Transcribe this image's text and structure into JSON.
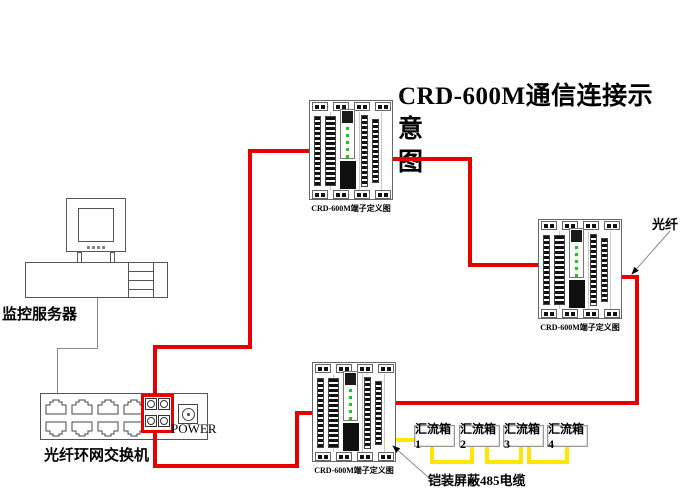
{
  "title": {
    "line1": "CRD-600M通信连接示意",
    "line2": "图"
  },
  "labels": {
    "server": "监控服务器",
    "switch_name": "光纤环网交换机",
    "power": "POWER",
    "fiber": "光纤",
    "cable485": "铠装屏蔽485电缆",
    "panel_caption": "CRD-600M端子定义图"
  },
  "combiner_boxes": [
    {
      "label": "汇流箱1"
    },
    {
      "label": "汇流箱2"
    },
    {
      "label": "汇流箱3"
    },
    {
      "label": "汇流箱4"
    }
  ],
  "colors": {
    "fiber_line": "#e60000",
    "cable485_line": "#ffe600",
    "led": "#19c819"
  }
}
